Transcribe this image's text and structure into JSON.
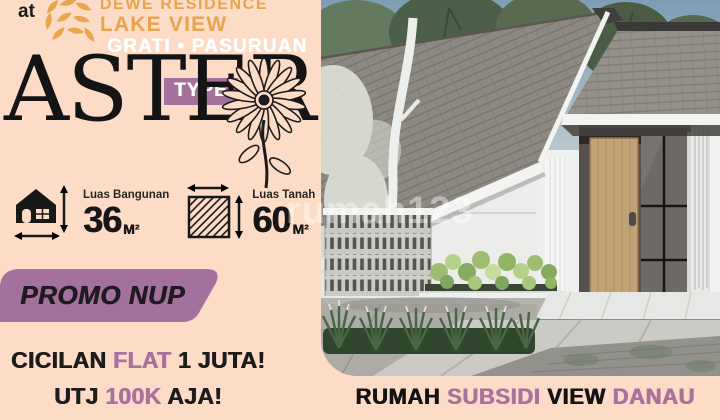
{
  "poster": {
    "brand": {
      "prefix": "at",
      "logo_icon": "petal-flower-logo",
      "line1": "DEWE RESIDENCE",
      "line2": "LAKE VIEW",
      "location": "GRATI • PASURUAN"
    },
    "type": {
      "badge": "TYPE",
      "name": "ASTER",
      "flower_icon": "aster-flower-icon"
    },
    "specs": [
      {
        "icon": "house-dimensions-icon",
        "label": "Luas Bangunan",
        "value": "36",
        "unit": "M²"
      },
      {
        "icon": "land-area-icon",
        "label": "Luas Tanah",
        "value": "60",
        "unit": "M²"
      }
    ],
    "promo": {
      "banner": "PROMO NUP",
      "line1_pre": "CICILAN ",
      "line1_highlight": "FLAT",
      "line1_post": " 1 JUTA!",
      "line2_pre": "UTJ ",
      "line2_highlight": "100K",
      "line2_post": " AJA!"
    },
    "caption": {
      "seg1": "RUMAH ",
      "seg2": "SUBSIDI",
      "seg3": " VIEW ",
      "seg4": "DANAU"
    },
    "watermark": "rumah123",
    "colors": {
      "background": "#fcdcc6",
      "gold": "#e8a44c",
      "purple": "#a4719c",
      "highlight_purple": "#a9719d",
      "text_black": "#1c1c1c",
      "white": "#ffffff"
    }
  }
}
